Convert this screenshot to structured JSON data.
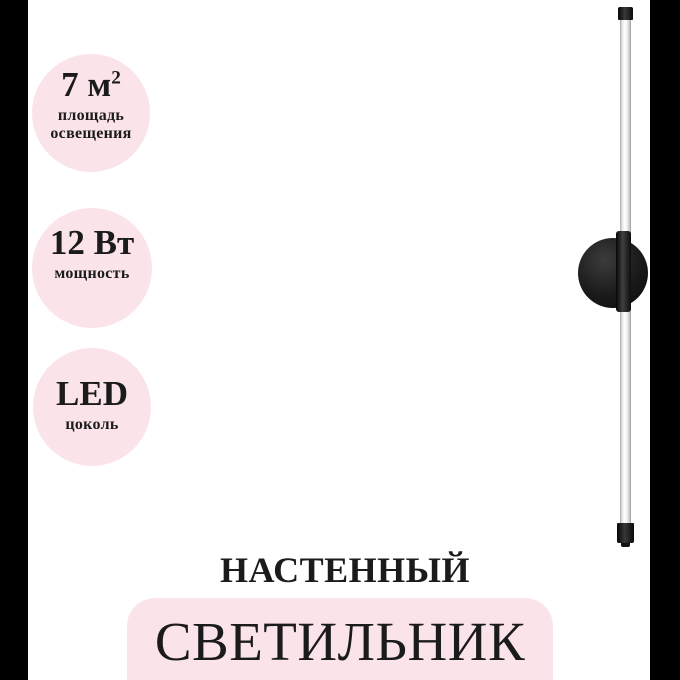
{
  "colors": {
    "accent_pink": "#fbe4e9",
    "side_bar_black": "#000000",
    "text_black": "#1b1b1b"
  },
  "spec_badges": [
    {
      "value": "7 м",
      "sup": "2",
      "lines": [
        "площадь",
        "освещения"
      ]
    },
    {
      "value": "12 Вт",
      "sup": "",
      "lines": [
        "мощность"
      ]
    },
    {
      "value": "LED",
      "sup": "",
      "lines": [
        "цоколь"
      ]
    }
  ],
  "captions": {
    "type": "НАСТЕННЫЙ",
    "name": "СВЕТИЛЬНИК"
  }
}
